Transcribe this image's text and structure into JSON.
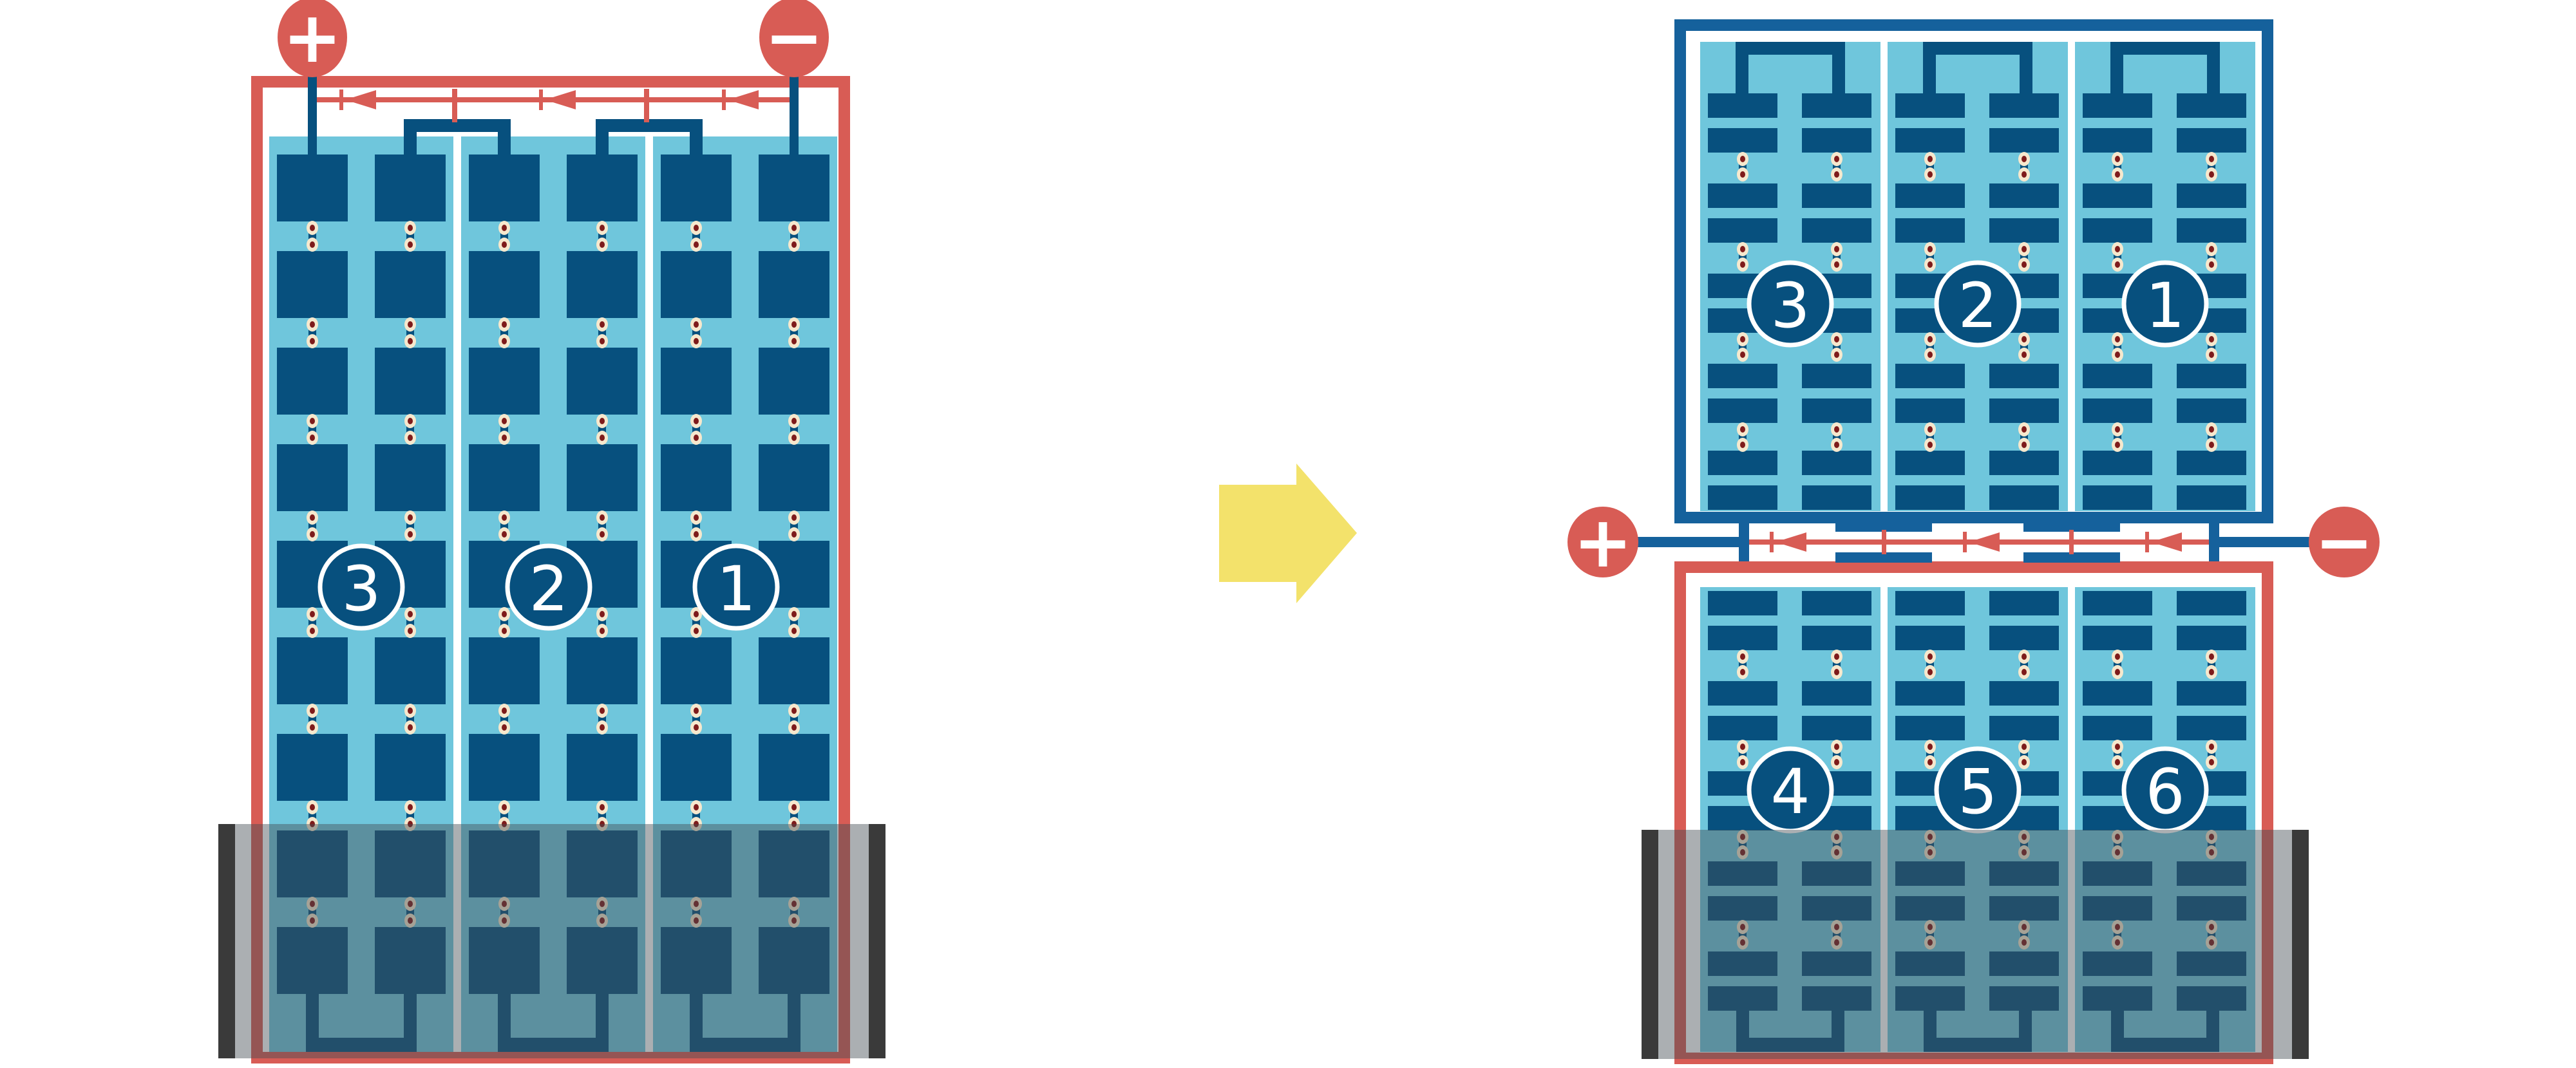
{
  "palette": {
    "red": "#d85c55",
    "navy_cell": "#07507e",
    "navy_frame": "#15619c",
    "light_blue": "#6fc6dc",
    "dot_outer": "#f6e8cd",
    "dot_inner": "#7e1b1b",
    "yellow": "#f3e26b",
    "gray_bar": "#3a3a3a",
    "overlay": "rgba(68,78,84,0.45)",
    "background": "#ffffff"
  },
  "figure": {
    "left_module": {
      "positive_label": "+",
      "negative_label": "−",
      "string_labels": [
        "3",
        "2",
        "1"
      ]
    },
    "right_module": {
      "positive_label": "+",
      "negative_label": "−",
      "top_string_labels": [
        "3",
        "2",
        "1"
      ],
      "bottom_string_labels": [
        "4",
        "5",
        "6"
      ]
    }
  }
}
